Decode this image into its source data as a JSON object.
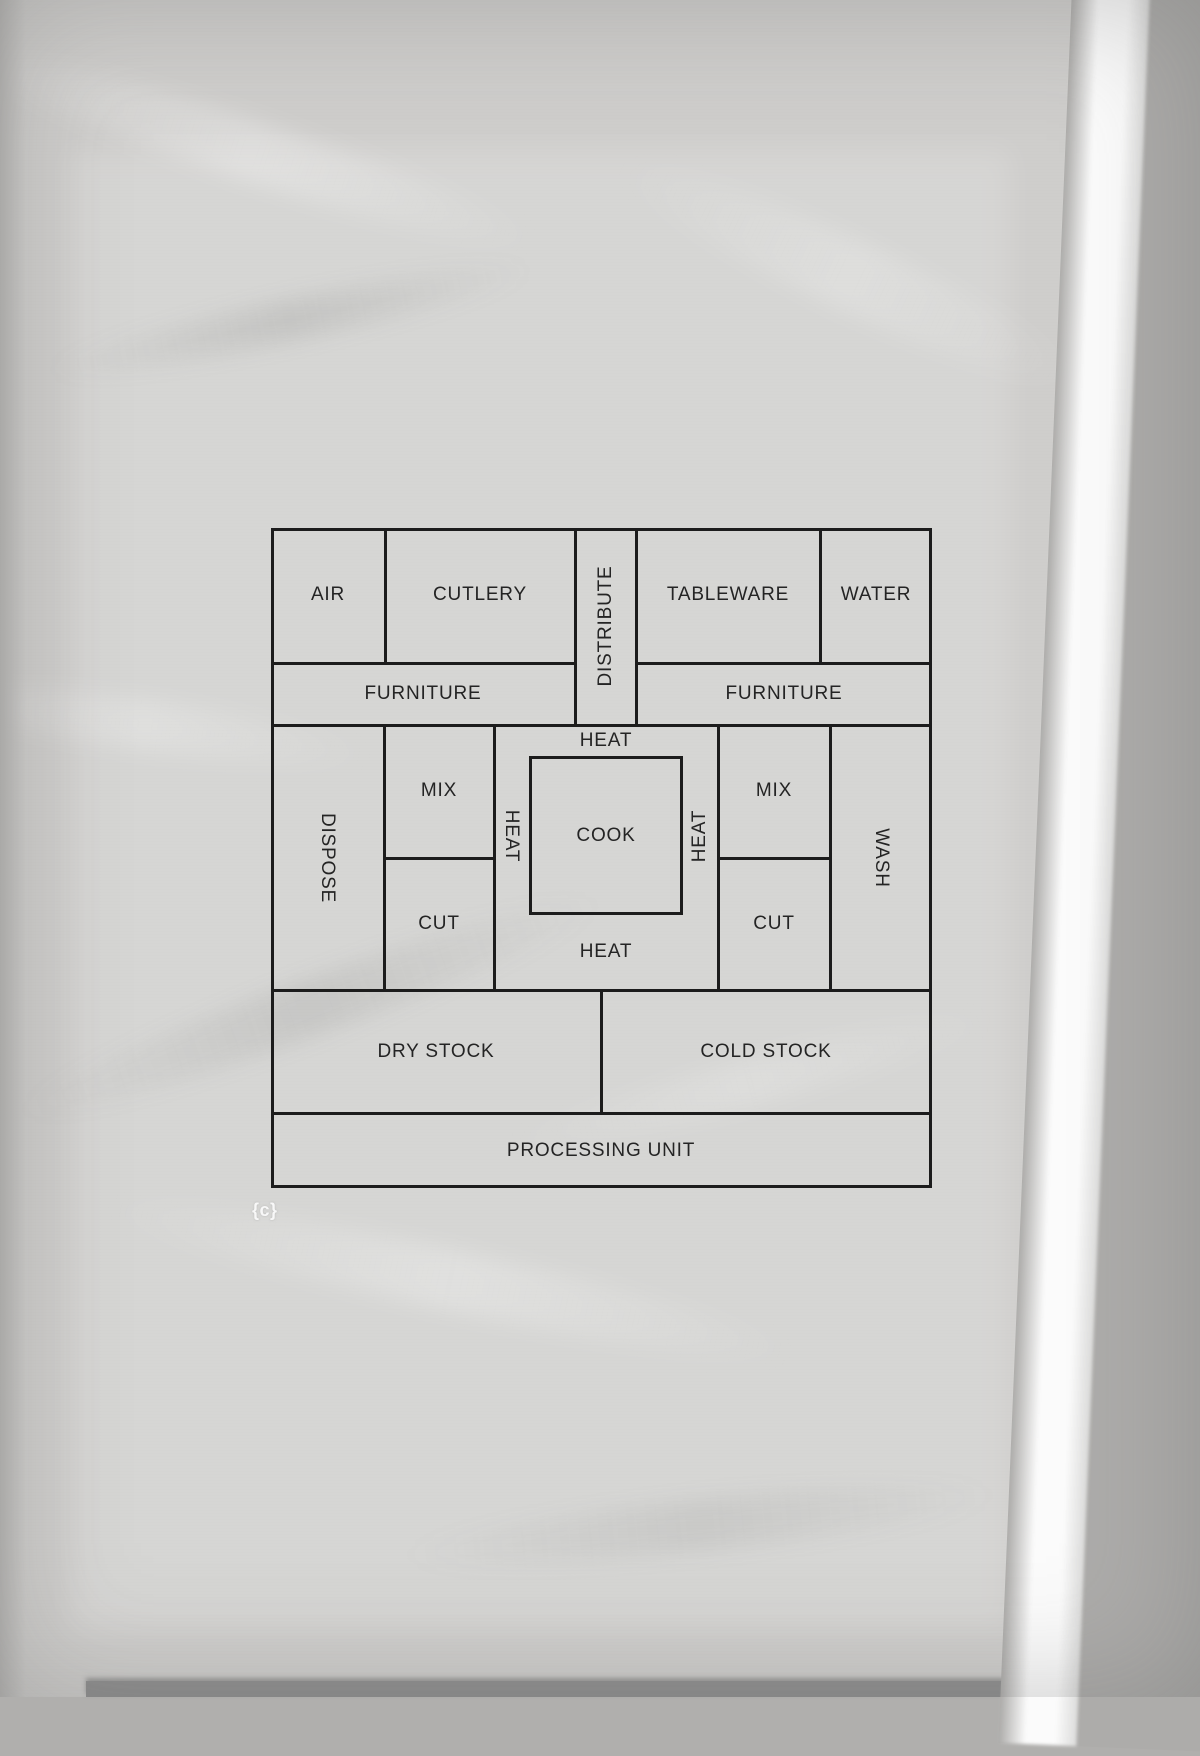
{
  "figure": {
    "caption": "{c}",
    "colors": {
      "line": "#1c1c1c",
      "paper": "#d2d1cf",
      "page_edge_white": "#fafafa",
      "scanner_gray": "#adacaa",
      "bottom_band": "#8f8f8f",
      "label_text": "#242424",
      "caption_text": "#f8f8f8"
    },
    "rooms": {
      "air": "AIR",
      "cutlery": "CUTLERY",
      "distribute": "DISTRIBUTE",
      "tableware": "TABLEWARE",
      "water": "WATER",
      "furniture_left": "FURNITURE",
      "furniture_right": "FURNITURE",
      "dispose": "DISPOSE",
      "mix_left": "MIX",
      "cut_left": "CUT",
      "heat_top": "HEAT",
      "heat_left": "HEAT",
      "cook": "COOK",
      "heat_right": "HEAT",
      "heat_bottom": "HEAT",
      "mix_right": "MIX",
      "cut_right": "CUT",
      "wash": "WASH",
      "dry_stock": "DRY STOCK",
      "cold_stock": "COLD STOCK",
      "processing_unit": "PROCESSING UNIT"
    }
  }
}
